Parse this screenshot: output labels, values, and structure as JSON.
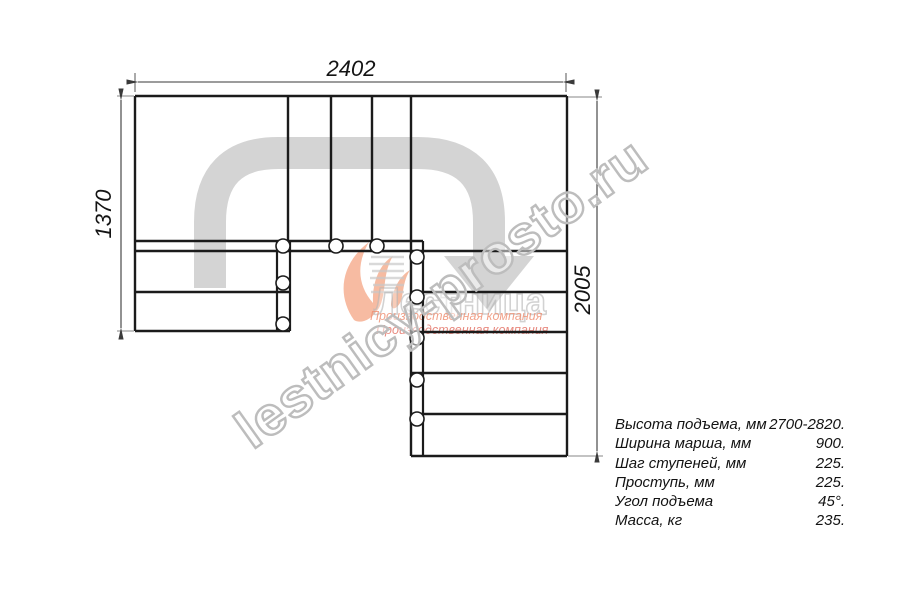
{
  "drawing": {
    "type": "staircase-plan-top-view",
    "dimensions": {
      "top_width_mm": "2402",
      "left_height_mm": "1370",
      "right_height_mm": "2005"
    },
    "colors": {
      "line": "#1b1b1b",
      "walkline": "#d4d4d4",
      "dimension": "#3a3a3a",
      "extension": "#9f9f9f"
    }
  },
  "specs": {
    "rows": [
      {
        "label": "Высота подъема, мм",
        "value": "2700-2820."
      },
      {
        "label": "Ширина марша, мм",
        "value": "900."
      },
      {
        "label": "Шаг ступеней, мм",
        "value": "225."
      },
      {
        "label": "Проступь, мм",
        "value": "225."
      },
      {
        "label": "Угол подъема",
        "value": "45°."
      },
      {
        "label": "Масса, кг",
        "value": "235."
      }
    ]
  },
  "watermark": {
    "site": "lestnicy-prosto.ru",
    "brand": "Лестница",
    "tagline1": "Производственная компания",
    "tagline2": "Производственная компания",
    "colors": {
      "outline": "#bdbdbd",
      "flame": "#f08456",
      "tagline": "#e4766a"
    }
  }
}
